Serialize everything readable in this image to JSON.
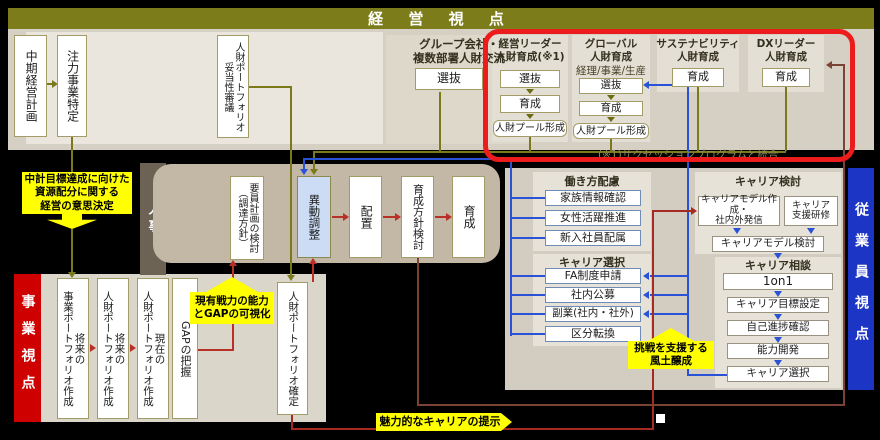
{
  "header": {
    "title": "経 営 視 点"
  },
  "top": {
    "mid_term_plan": "中期経営計画",
    "focus_business": "注力事業特定",
    "portfolio_review": "人財ポートフォリオ\n妥当性審議",
    "group_exchange": {
      "title": "グループ会社・\n複数部署人財交流",
      "select": "選抜"
    },
    "leader_dev": {
      "title": "経営リーダー\n人財育成(※1)",
      "steps": [
        "選抜",
        "育成",
        "人財プール形成"
      ]
    },
    "global_dev": {
      "title": "グローバル\n人財育成",
      "subtitle": "経理/事業/生産",
      "steps": [
        "選抜",
        "育成",
        "人財プール形成"
      ]
    },
    "sustainability_dev": {
      "title": "サステナビリティ\n人財育成",
      "step": "育成"
    },
    "dx_dev": {
      "title": "DXリーダー\n人財育成",
      "step": "育成"
    },
    "note": "(※1)サクセッションプログラムと統合"
  },
  "hr": {
    "label": "人事",
    "items": [
      "要員計画の検討\n（調達方針）",
      "異動調整",
      "配置",
      "育成方針検討",
      "育成"
    ]
  },
  "business": {
    "label": "事業視点",
    "items": [
      "将来の\n事業ポートフォリオ作成",
      "将来の\n人財ポートフォリオ作成",
      "現在の\n人財ポートフォリオ作成",
      "GAPの把握"
    ],
    "portfolio_fix": "人財ポートフォリオ確定"
  },
  "employee": {
    "label": "従業員視点",
    "workstyle": {
      "title": "働き方配慮",
      "items": [
        "家族情報確認",
        "女性活躍推進",
        "新入社員配属"
      ]
    },
    "career_select": {
      "title": "キャリア選択",
      "items": [
        "FA制度申請",
        "社内公募",
        "副業(社内・社外)",
        "区分転換"
      ]
    },
    "career_study": {
      "title": "キャリア検討",
      "model_create": "キャリアモデル作成・\n社内外発信",
      "training": "キャリア\n支援研修",
      "model_review": "キャリアモデル検討"
    },
    "career_consult": {
      "title": "キャリア相談",
      "items": [
        "1on1",
        "キャリア目標設定",
        "自己進捗確認",
        "能力開発",
        "キャリア選択"
      ]
    }
  },
  "callouts": {
    "decision": "中計目標達成に向けた\n資源配分に関する\n経営の意思決定",
    "gap_viz": "現有戦力の能力\nとGAPの可視化",
    "culture": "挑戦を支援する\n風土醸成",
    "career_offer": "魅力的なキャリアの提示"
  },
  "colors": {
    "olive": "#7a7a1a",
    "olive_bar": "#7c7c1b",
    "beige_panel": "#d6d0c4",
    "beige_light": "#eae6de",
    "hr_brown": "#6d6355",
    "hr_panel": "#c2b8a5",
    "red_bar": "#ce0000",
    "blue_bar": "#1d35c4",
    "frame_red": "#ec1c1c",
    "yellow": "#ffff00",
    "line_blue": "#2a52d6",
    "line_red": "#b83028",
    "line_darkred": "#a62a22",
    "line_brown": "#7b4334",
    "idou_blue": "#cbdcf4"
  }
}
